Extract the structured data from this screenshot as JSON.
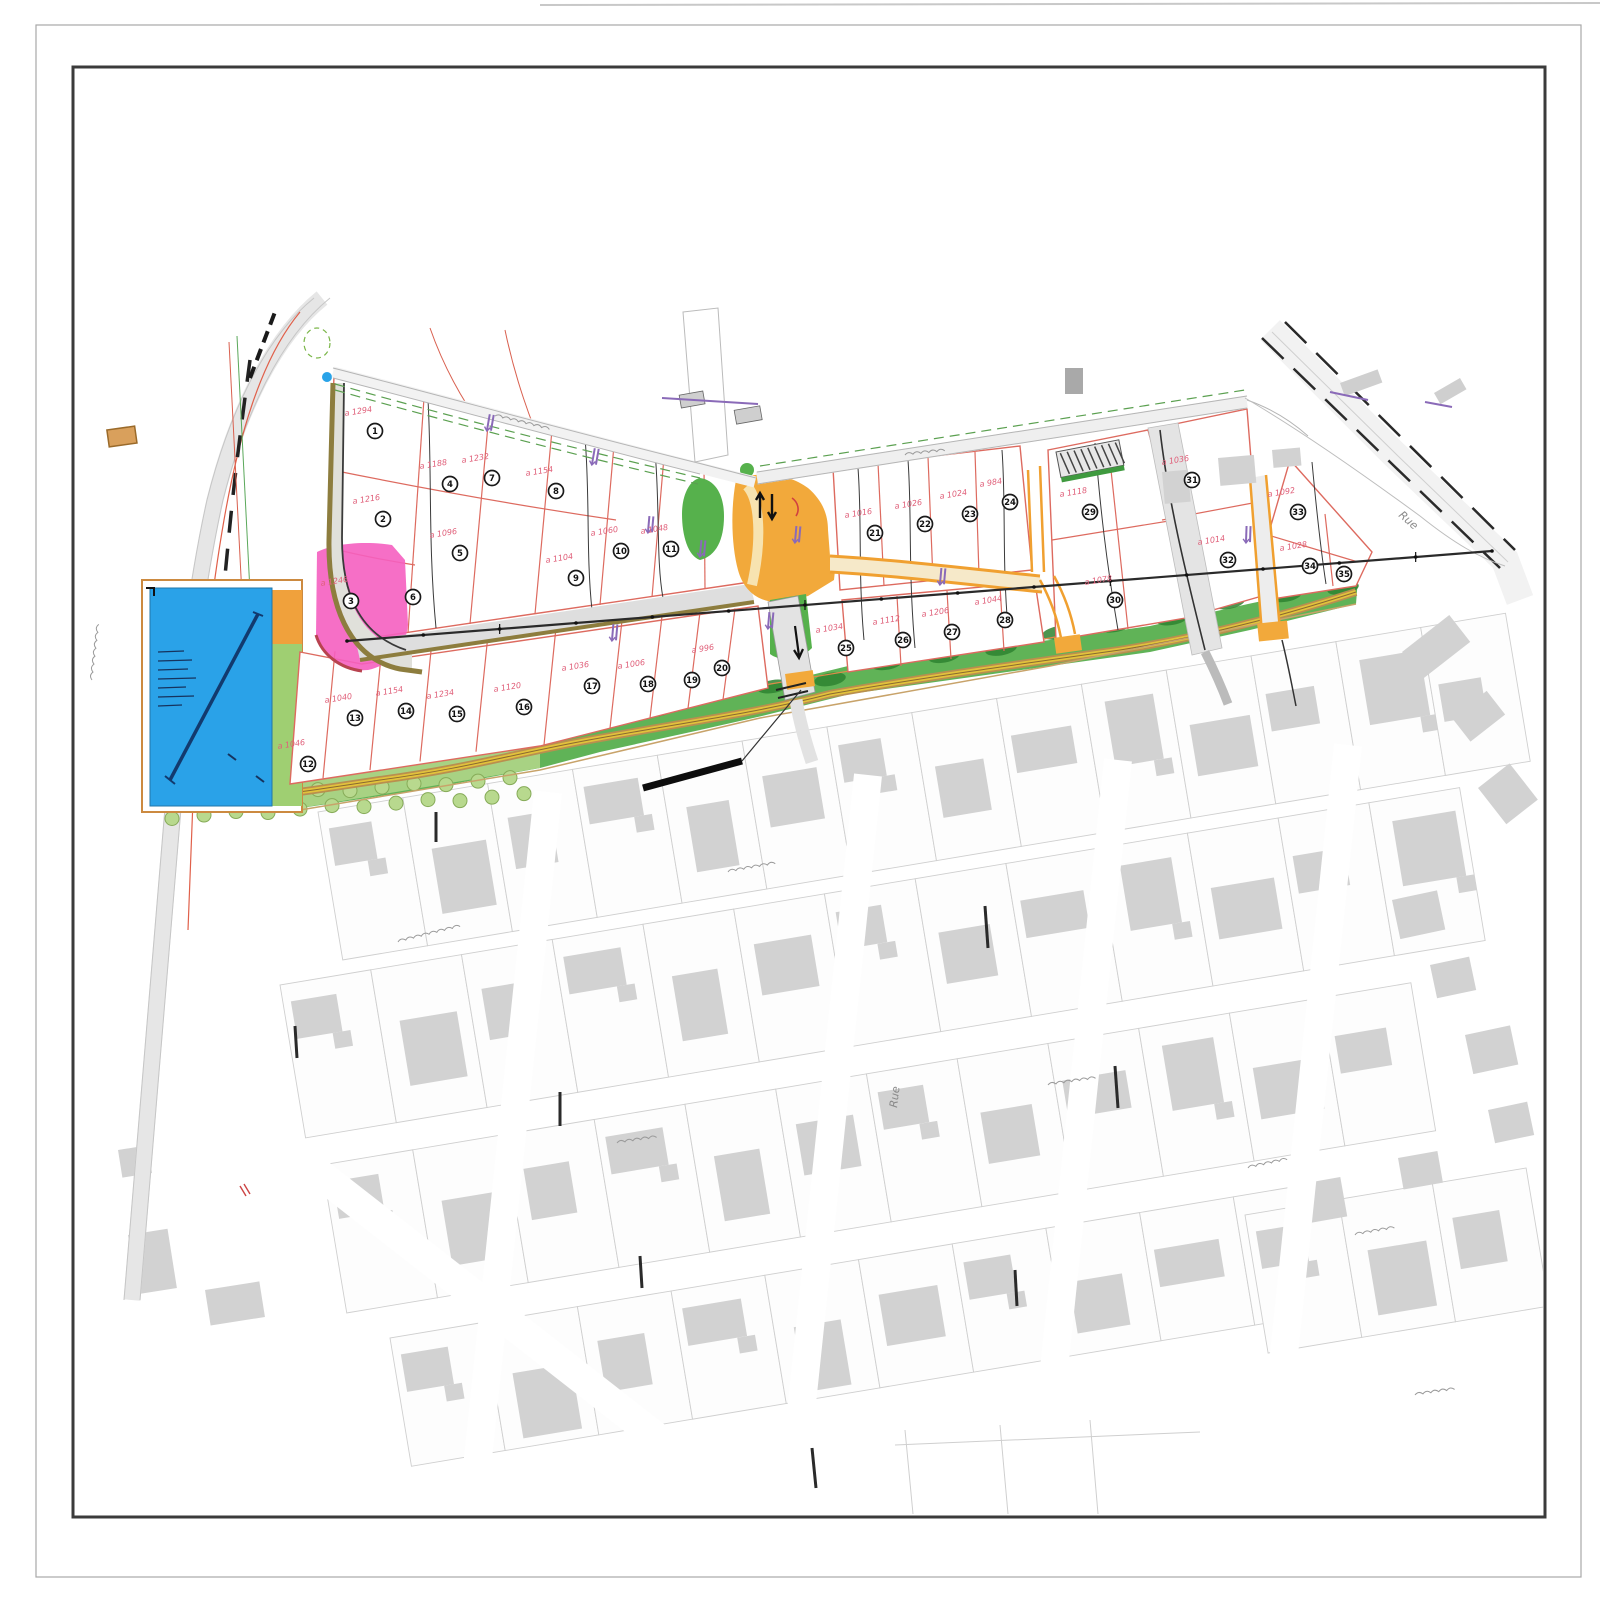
{
  "document": {
    "type": "scanned land subdivision site plan (plan de lotissement) over cadastral background",
    "sheet_background": "#ffffff"
  },
  "palette": {
    "frame_inner": "#3b3b3b",
    "frame_outer": "#a8a8a8",
    "lot_boundary_red": "#dd6a5f",
    "area_label_red": "#e0607a",
    "highlight_pink": "#f55fc0",
    "basin_blue": "#2aa2e8",
    "basin_note_ink": "#16335e",
    "road_orange": "#f2a93b",
    "path_yellow": "#e2c23c",
    "path_casing_tan": "#b98f4e",
    "green_belt": "#53ad49",
    "green_light": "#a8d283",
    "green_dark_shrub": "#2e8230",
    "olive_edge": "#8d7d3e",
    "existing_building_gray": "#d2d2d2",
    "parcel_line_gray": "#cfcfcf",
    "road_gray": "#e4e4e4",
    "utility_purple": "#8a6ab8",
    "survey_line_black": "#2a2a2a"
  },
  "street_labels": [
    {
      "text": "Rue"
    },
    {
      "text": "Rue"
    }
  ],
  "features": {
    "retention_basin": {
      "label": "retention-basin",
      "color": "#2aa2e8"
    },
    "highlighted_lot": {
      "label": "highlighted-lot",
      "color": "#f55fc0"
    },
    "entrance_plaza": {
      "label": "entrance-plaza",
      "color": "#f2a93b"
    },
    "green_belt": {
      "label": "green-belt",
      "color": "#53ad49"
    },
    "parking_bays": {
      "label": "parking-bays",
      "stall_count": 9
    }
  },
  "lots": [
    {
      "n": "1",
      "a": "a 1294",
      "x": 375,
      "y": 431
    },
    {
      "n": "2",
      "a": "a 1216",
      "x": 383,
      "y": 519
    },
    {
      "n": "3",
      "a": "a 1246",
      "x": 351,
      "y": 601
    },
    {
      "n": "4",
      "a": "a 1188",
      "x": 450,
      "y": 484
    },
    {
      "n": "5",
      "a": "a 1096",
      "x": 460,
      "y": 553
    },
    {
      "n": "6",
      "a": "",
      "x": 413,
      "y": 597
    },
    {
      "n": "7",
      "a": "a 1232",
      "x": 492,
      "y": 478
    },
    {
      "n": "8",
      "a": "a 1154",
      "x": 556,
      "y": 491
    },
    {
      "n": "9",
      "a": "a 1104",
      "x": 576,
      "y": 578
    },
    {
      "n": "10",
      "a": "a 1060",
      "x": 621,
      "y": 551
    },
    {
      "n": "11",
      "a": "a 1048",
      "x": 671,
      "y": 549
    },
    {
      "n": "12",
      "a": "a 1046",
      "x": 308,
      "y": 764
    },
    {
      "n": "13",
      "a": "a 1040",
      "x": 355,
      "y": 718
    },
    {
      "n": "14",
      "a": "a 1154",
      "x": 406,
      "y": 711
    },
    {
      "n": "15",
      "a": "a 1234",
      "x": 457,
      "y": 714
    },
    {
      "n": "16",
      "a": "a 1120",
      "x": 524,
      "y": 707
    },
    {
      "n": "17",
      "a": "a 1036",
      "x": 592,
      "y": 686
    },
    {
      "n": "18",
      "a": "a 1006",
      "x": 648,
      "y": 684
    },
    {
      "n": "19",
      "a": "",
      "x": 692,
      "y": 680
    },
    {
      "n": "20",
      "a": "a 996",
      "x": 722,
      "y": 668
    },
    {
      "n": "21",
      "a": "a 1016",
      "x": 875,
      "y": 533
    },
    {
      "n": "22",
      "a": "a 1026",
      "x": 925,
      "y": 524
    },
    {
      "n": "23",
      "a": "a 1024",
      "x": 970,
      "y": 514
    },
    {
      "n": "24",
      "a": "a 984",
      "x": 1010,
      "y": 502
    },
    {
      "n": "25",
      "a": "a 1034",
      "x": 846,
      "y": 648
    },
    {
      "n": "26",
      "a": "a 1112",
      "x": 903,
      "y": 640
    },
    {
      "n": "27",
      "a": "a 1206",
      "x": 952,
      "y": 632
    },
    {
      "n": "28",
      "a": "a 1044",
      "x": 1005,
      "y": 620
    },
    {
      "n": "29",
      "a": "a 1118",
      "x": 1090,
      "y": 512
    },
    {
      "n": "30",
      "a": "a 1078",
      "x": 1115,
      "y": 600
    },
    {
      "n": "31",
      "a": "a 1036",
      "x": 1192,
      "y": 480
    },
    {
      "n": "32",
      "a": "a 1014",
      "x": 1228,
      "y": 560
    },
    {
      "n": "33",
      "a": "a 1092",
      "x": 1298,
      "y": 512
    },
    {
      "n": "34",
      "a": "a 1028",
      "x": 1310,
      "y": 566
    },
    {
      "n": "35",
      "a": "",
      "x": 1344,
      "y": 574
    }
  ]
}
